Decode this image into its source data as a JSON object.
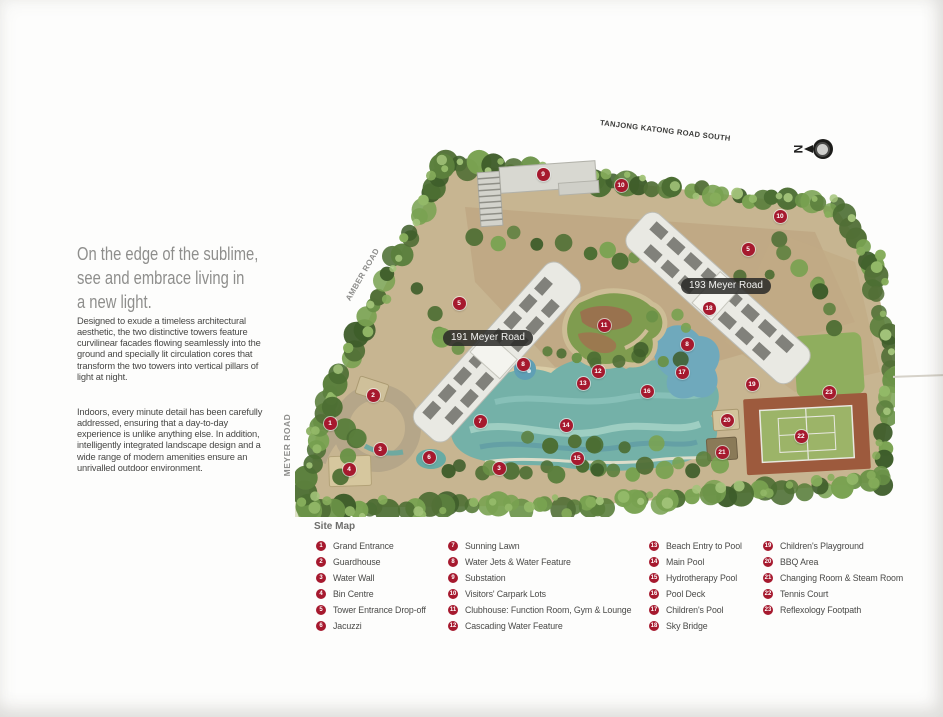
{
  "intro": {
    "headline_lines": [
      "On the edge of the sublime,",
      "see and embrace living in",
      "a new light."
    ],
    "para1": "Designed to exude a timeless architectural aesthetic, the two distinctive towers feature curvilinear facades flowing seamlessly into the ground and specially lit circulation cores that transform the two towers into vertical pillars of light at night.",
    "para2": "Indoors, every minute detail has been carefully addressed, ensuring that a day-to-day experience is unlike anything else. In addition, intelligently integrated landscape design and a wide range of modern amenities ensure an unrivalled outdoor environment."
  },
  "map": {
    "roads": {
      "top": "TANJONG KATONG ROAD SOUTH",
      "left": "AMBER ROAD",
      "bottom_left": "MEYER ROAD"
    },
    "buildings": {
      "b191": "191 Meyer Road",
      "b193": "193 Meyer Road"
    },
    "compass": {
      "label": "N"
    },
    "marker_color": "#a6192e",
    "markers": [
      {
        "n": "1",
        "x": 35,
        "y": 311
      },
      {
        "n": "2",
        "x": 78,
        "y": 283
      },
      {
        "n": "3",
        "x": 85,
        "y": 337
      },
      {
        "n": "3",
        "x": 204,
        "y": 356
      },
      {
        "n": "4",
        "x": 54,
        "y": 357
      },
      {
        "n": "5",
        "x": 164,
        "y": 191
      },
      {
        "n": "5",
        "x": 453,
        "y": 137
      },
      {
        "n": "6",
        "x": 134,
        "y": 345
      },
      {
        "n": "7",
        "x": 185,
        "y": 309
      },
      {
        "n": "8",
        "x": 228,
        "y": 252
      },
      {
        "n": "8",
        "x": 392,
        "y": 232
      },
      {
        "n": "9",
        "x": 248,
        "y": 62
      },
      {
        "n": "10",
        "x": 326,
        "y": 73
      },
      {
        "n": "10",
        "x": 485,
        "y": 104
      },
      {
        "n": "11",
        "x": 309,
        "y": 213
      },
      {
        "n": "12",
        "x": 303,
        "y": 259
      },
      {
        "n": "13",
        "x": 288,
        "y": 271
      },
      {
        "n": "14",
        "x": 271,
        "y": 313
      },
      {
        "n": "15",
        "x": 282,
        "y": 346
      },
      {
        "n": "16",
        "x": 352,
        "y": 279
      },
      {
        "n": "17",
        "x": 387,
        "y": 260
      },
      {
        "n": "18",
        "x": 414,
        "y": 196
      },
      {
        "n": "19",
        "x": 457,
        "y": 272
      },
      {
        "n": "20",
        "x": 432,
        "y": 308
      },
      {
        "n": "21",
        "x": 427,
        "y": 340
      },
      {
        "n": "22",
        "x": 506,
        "y": 324
      },
      {
        "n": "23",
        "x": 534,
        "y": 280
      }
    ]
  },
  "legend": {
    "title": "Site Map",
    "columns": [
      {
        "items": [
          {
            "n": "1",
            "label": "Grand Entrance"
          },
          {
            "n": "2",
            "label": "Guardhouse"
          },
          {
            "n": "3",
            "label": "Water Wall"
          },
          {
            "n": "4",
            "label": "Bin Centre"
          },
          {
            "n": "5",
            "label": "Tower Entrance Drop-off"
          },
          {
            "n": "6",
            "label": "Jacuzzi"
          }
        ]
      },
      {
        "items": [
          {
            "n": "7",
            "label": "Sunning Lawn"
          },
          {
            "n": "8",
            "label": "Water Jets & Water Feature"
          },
          {
            "n": "9",
            "label": "Substation"
          },
          {
            "n": "10",
            "label": "Visitors' Carpark Lots"
          },
          {
            "n": "11",
            "label": "Clubhouse: Function Room, Gym & Lounge"
          },
          {
            "n": "12",
            "label": "Cascading Water Feature"
          }
        ]
      },
      {
        "items": [
          {
            "n": "13",
            "label": "Beach Entry to Pool"
          },
          {
            "n": "14",
            "label": "Main Pool"
          },
          {
            "n": "15",
            "label": "Hydrotherapy Pool"
          },
          {
            "n": "16",
            "label": "Pool Deck"
          },
          {
            "n": "17",
            "label": "Children's Pool"
          },
          {
            "n": "18",
            "label": "Sky Bridge"
          }
        ]
      },
      {
        "items": [
          {
            "n": "19",
            "label": "Children's Playground"
          },
          {
            "n": "20",
            "label": "BBQ Area"
          },
          {
            "n": "21",
            "label": "Changing Room & Steam Room"
          },
          {
            "n": "22",
            "label": "Tennis Court"
          },
          {
            "n": "23",
            "label": "Reflexology Footpath"
          }
        ]
      }
    ]
  }
}
